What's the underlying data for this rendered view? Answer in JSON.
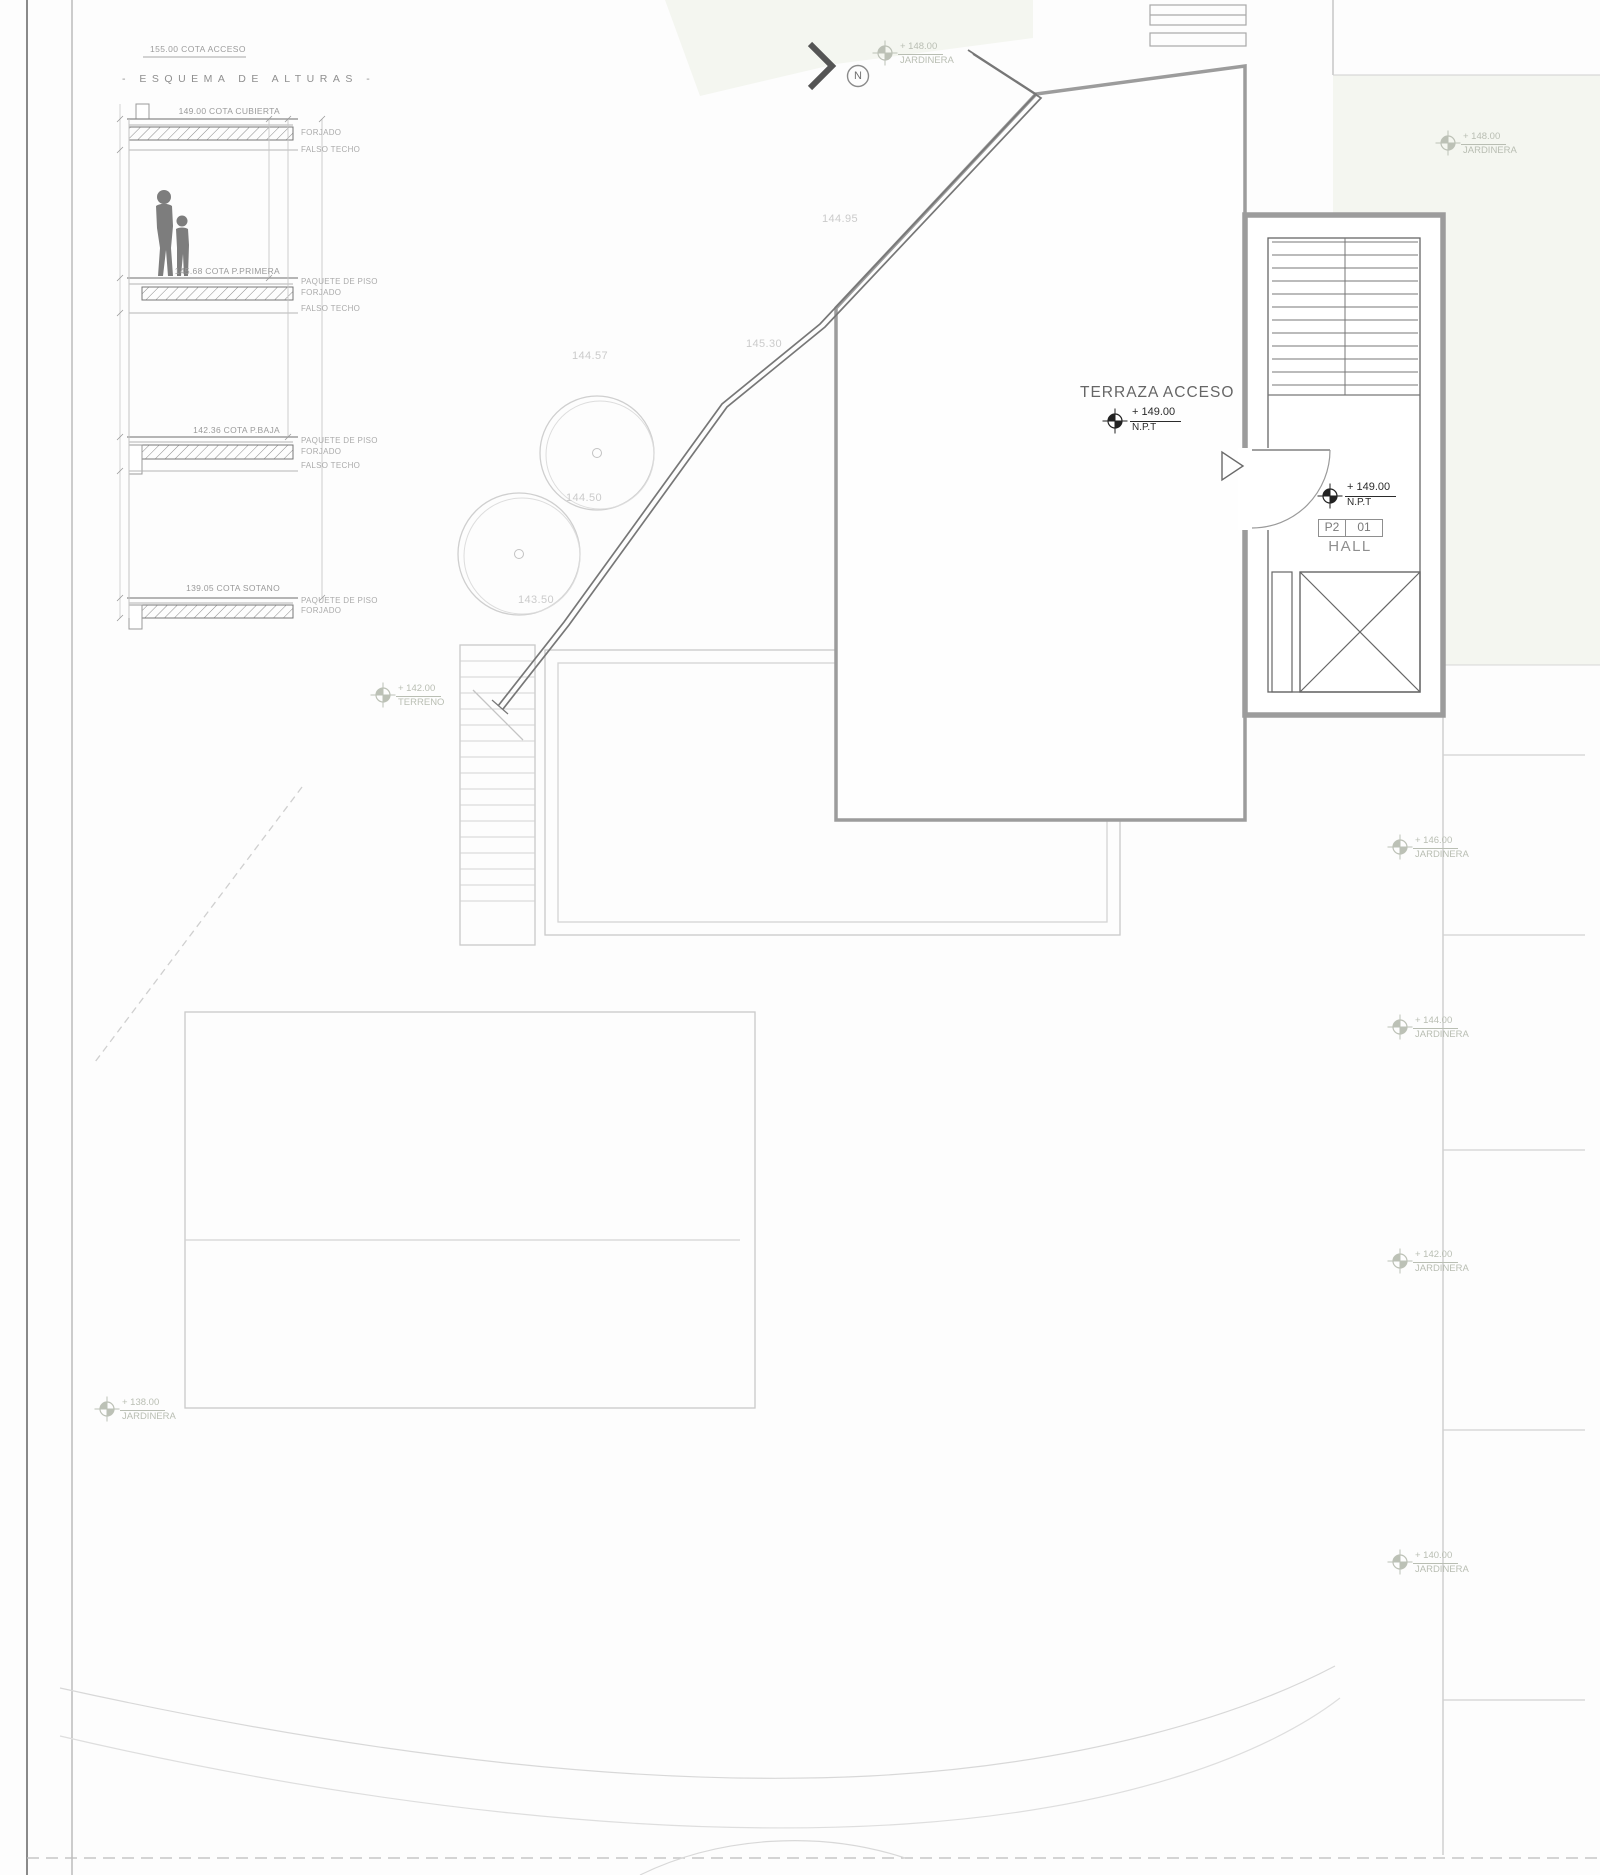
{
  "drawing": {
    "access_note": "155.00 COTA ACCESO",
    "scheme_title": "- ESQUEMA DE ALTURAS -",
    "levels": [
      {
        "cota": "149.00 COTA CUBIERTA",
        "notes": [
          "FORJADO",
          "FALSO TECHO"
        ]
      },
      {
        "cota": "145.68 COTA P.PRIMERA",
        "notes": [
          "PAQUETE DE PISO",
          "FORJADO",
          "FALSO TECHO"
        ]
      },
      {
        "cota": "142.36 COTA P.BAJA",
        "notes": [
          "PAQUETE DE PISO",
          "FORJADO",
          "FALSO TECHO"
        ]
      },
      {
        "cota": "139.05 COTA SOTANO",
        "notes": [
          "PAQUETE DE PISO",
          "FORJADO"
        ]
      }
    ],
    "north_label": "N"
  },
  "plan": {
    "terraza": {
      "title": "TERRAZA ACCESO",
      "level": "+ 149.00",
      "datum": "N.P.T"
    },
    "hall": {
      "level": "+ 149.00",
      "datum": "N.P.T",
      "tag_zone": "P2",
      "tag_num": "01",
      "room": "HALL"
    },
    "terreno": {
      "level": "+ 142.00",
      "label": "TERRENO"
    },
    "jardineras": [
      {
        "level": "+ 148.00",
        "label": "JARDINERA"
      },
      {
        "level": "+ 148.00",
        "label": "JARDINERA"
      },
      {
        "level": "+ 146.00",
        "label": "JARDINERA"
      },
      {
        "level": "+ 144.00",
        "label": "JARDINERA"
      },
      {
        "level": "+ 142.00",
        "label": "JARDINERA"
      },
      {
        "level": "+ 140.00",
        "label": "JARDINERA"
      },
      {
        "level": "+ 138.00",
        "label": "JARDINERA"
      }
    ],
    "contours": [
      {
        "value": "144.95"
      },
      {
        "value": "145.30"
      },
      {
        "value": "144.57"
      },
      {
        "value": "144.50"
      },
      {
        "value": "143.50"
      }
    ]
  },
  "colors": {
    "wall_dark": "#6e6e6e",
    "building_gray": "#9c9c9c",
    "line_light": "#c9c9c9",
    "tint_green": "#f4f6f0",
    "marker_dark": "#222222",
    "marker_light": "#bcc1b6",
    "text_gray": "#9a9a9a"
  }
}
